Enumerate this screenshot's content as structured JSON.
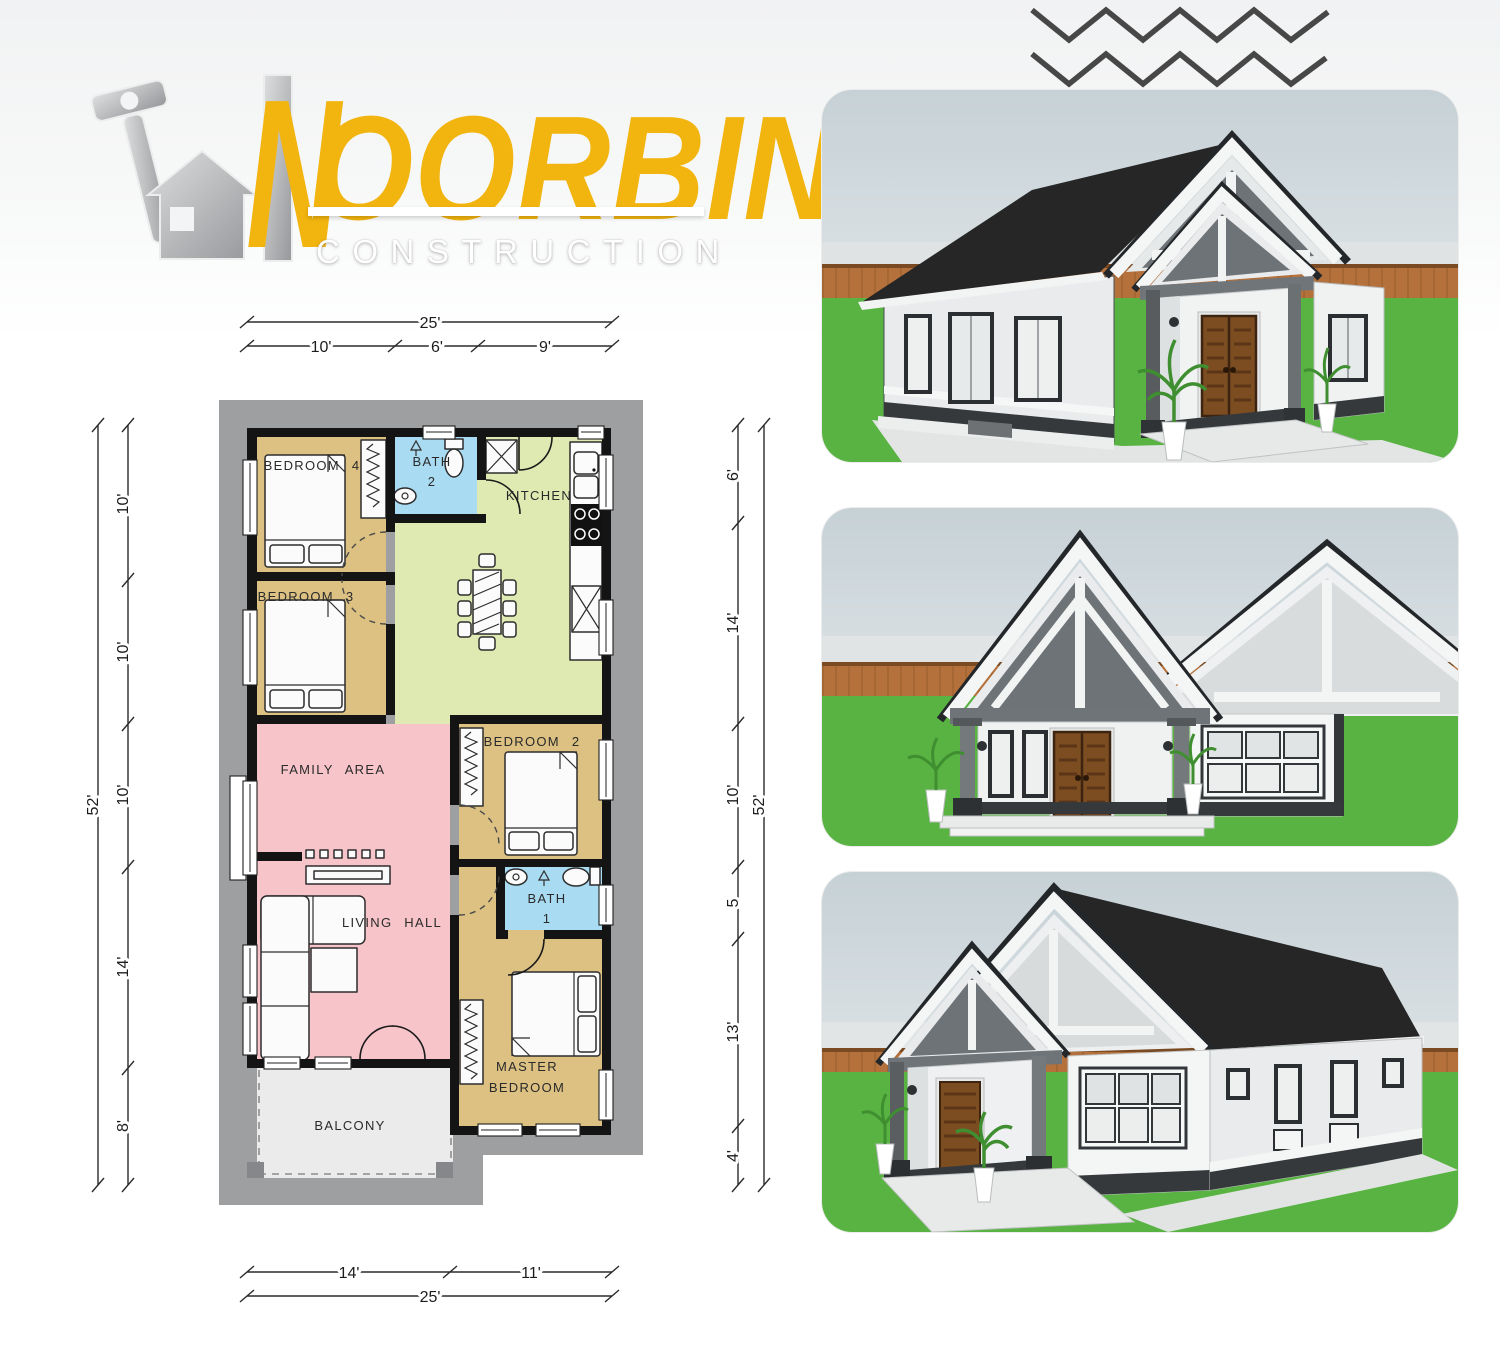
{
  "logo": {
    "initial": "N",
    "name_rest": "OORBINA",
    "subtitle": "CONSTRUCTION"
  },
  "floor_plan": {
    "rooms": {
      "bedroom4": "BEDROOM 4",
      "bath2_line1": "BATH",
      "bath2_line2": "2",
      "kitchen": "KITCHEN",
      "bedroom3": "BEDROOM 3",
      "family": "FAMILY AREA",
      "bedroom2": "BEDROOM 2",
      "living": "LIVING HALL",
      "bath1_line1": "BATH",
      "bath1_line2": "1",
      "master_line1": "MASTER",
      "master_line2": "BEDROOM",
      "balcony": "BALCONY"
    },
    "dims": {
      "top_total": "25'",
      "top_segments": [
        "10'",
        "6'",
        "9'"
      ],
      "left_total": "52'",
      "left_segments": [
        "10'",
        "10'",
        "10'",
        "14'",
        "8'"
      ],
      "right_total": "52'",
      "right_segments": [
        "6'",
        "14'",
        "10'",
        "5",
        "13'",
        "4'"
      ],
      "bottom_total": "25'",
      "bottom_segments": [
        "14'",
        "11'"
      ]
    }
  },
  "colors": {
    "accent_yellow": "#f2b40e",
    "zigzag": "#474747",
    "plan_wall": "#141414",
    "plan_border": "#9d9fa1",
    "room_bedroom": "#dcc183",
    "room_bath": "#a9dcf2",
    "room_kitchen": "#dfe9b2",
    "room_living": "#f7c5c9",
    "room_balcony": "#ebebeb",
    "dim_text": "#1c1c1c",
    "sky": "#c6d1d6",
    "sky_low": "#eef1f2",
    "grass": "#59b342",
    "fence": "#b5713c",
    "roof": "#262626",
    "wall_white": "#f4f5f5",
    "wall_shade": "#e9ebec",
    "trim_dark": "#35393c",
    "column_gray": "#6e7377",
    "door_brown": "#7d4d22"
  }
}
